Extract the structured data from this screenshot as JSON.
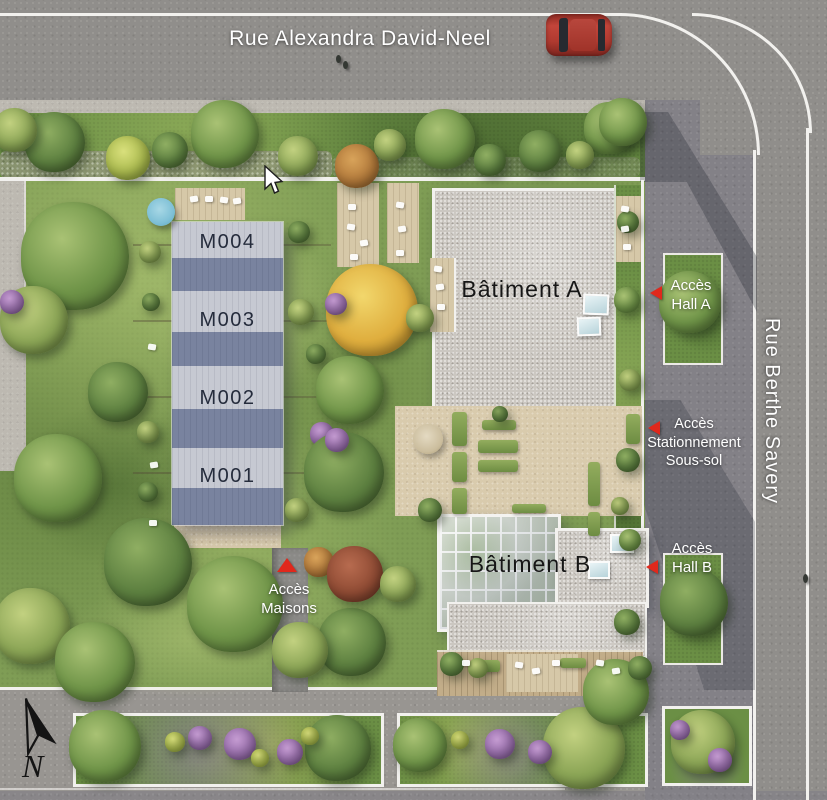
{
  "streets": {
    "top": "Rue Alexandra David-Neel",
    "right": "Rue Berthe Savery"
  },
  "buildings": {
    "a": "Bâtiment A",
    "b": "Bâtiment B"
  },
  "maisons": {
    "units": [
      "M004",
      "M003",
      "M002",
      "M001"
    ]
  },
  "access": {
    "hall_a": {
      "lines": [
        "Accès",
        "Hall A"
      ]
    },
    "parking": {
      "lines": [
        "Accès",
        "Stationnement",
        "Sous-sol"
      ]
    },
    "hall_b": {
      "lines": [
        "Accès",
        "Hall B"
      ]
    },
    "maisons": {
      "lines": [
        "Accès",
        "Maisons"
      ]
    }
  },
  "compass": {
    "label": "N"
  },
  "colors": {
    "accent_red": "#e0281c",
    "roof_light": "#c6c9d2",
    "roof_dark": "#79839f",
    "street_gray": "#908e8b",
    "lawn_green": "#7f9d55",
    "gravel_roof": "#cbc7c1",
    "terrace_beige": "#d9cbad"
  }
}
